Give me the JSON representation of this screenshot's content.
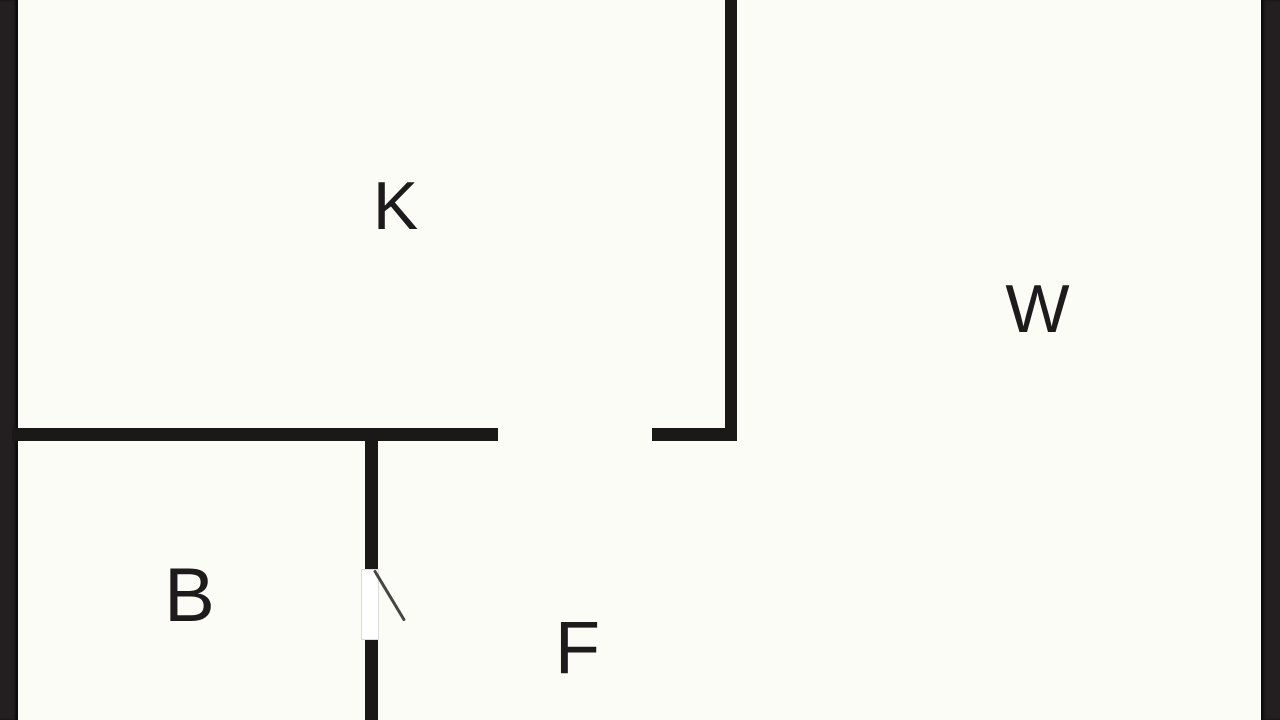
{
  "floorplan": {
    "rooms": [
      {
        "key": "k",
        "label": "K"
      },
      {
        "key": "w",
        "label": "W"
      },
      {
        "key": "b",
        "label": "B"
      },
      {
        "key": "f",
        "label": "F"
      }
    ],
    "colors": {
      "background": "#fcfcf6",
      "walls": "#1b1818",
      "letterbox": "#231f20",
      "door_swing_line": "#454545",
      "door_opening": "#ffffff",
      "label_text": "#1d1b1b"
    }
  }
}
